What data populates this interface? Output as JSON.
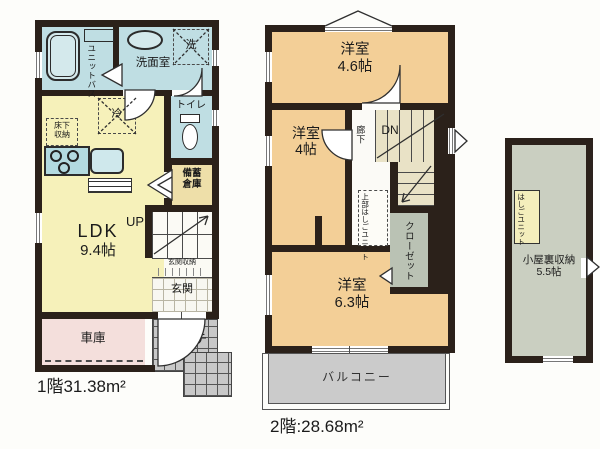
{
  "colors": {
    "wall": "#2b211a",
    "ldk_yellow": "#f6f1ba",
    "wet_blue": "#bfdee3",
    "room_tan": "#f3cf97",
    "garage_pink": "#f4dfdc",
    "porch_gray": "#c8c8c8",
    "balcony_gray": "#cbcbcb",
    "attic_sage": "#cacfc1",
    "closet_sage": "#bac2b4",
    "stairs_beige": "#e9e2c6",
    "storage_khaki": "#eedfa9"
  },
  "floor1": {
    "area_label": "1階31.38m²",
    "unit_bath_l1": "ユニット",
    "unit_bath_l2": "バス",
    "washroom": "洗面室",
    "washer": "洗",
    "toilet": "トイレ",
    "fridge": "冷",
    "floor_storage_l1": "床下",
    "floor_storage_l2": "収納",
    "ldk_l1": "LDK",
    "ldk_l2": "9.4帖",
    "up": "UP",
    "stock_l1": "備蓄",
    "stock_l2": "倉庫",
    "entry_storage": "玄関収納",
    "entry": "玄関",
    "garage": "車庫",
    "porch": "ポーチ"
  },
  "floor2": {
    "area_label": "2階:28.68m²",
    "room46_l1": "洋室",
    "room46_l2": "4.6帖",
    "room4_l1": "洋室",
    "room4_l2": "4帖",
    "hall": "廊下",
    "dn": "DN",
    "ladder_l1": "上部はしご",
    "ladder_l2": "ユニット",
    "closet": "クローゼット",
    "room63_l1": "洋室",
    "room63_l2": "6.3帖",
    "balcony": "バルコニー"
  },
  "attic": {
    "ladder_l1": "はしご",
    "ladder_l2": "ユニット",
    "name_l1": "小屋裏収納",
    "name_l2": "5.5帖"
  }
}
